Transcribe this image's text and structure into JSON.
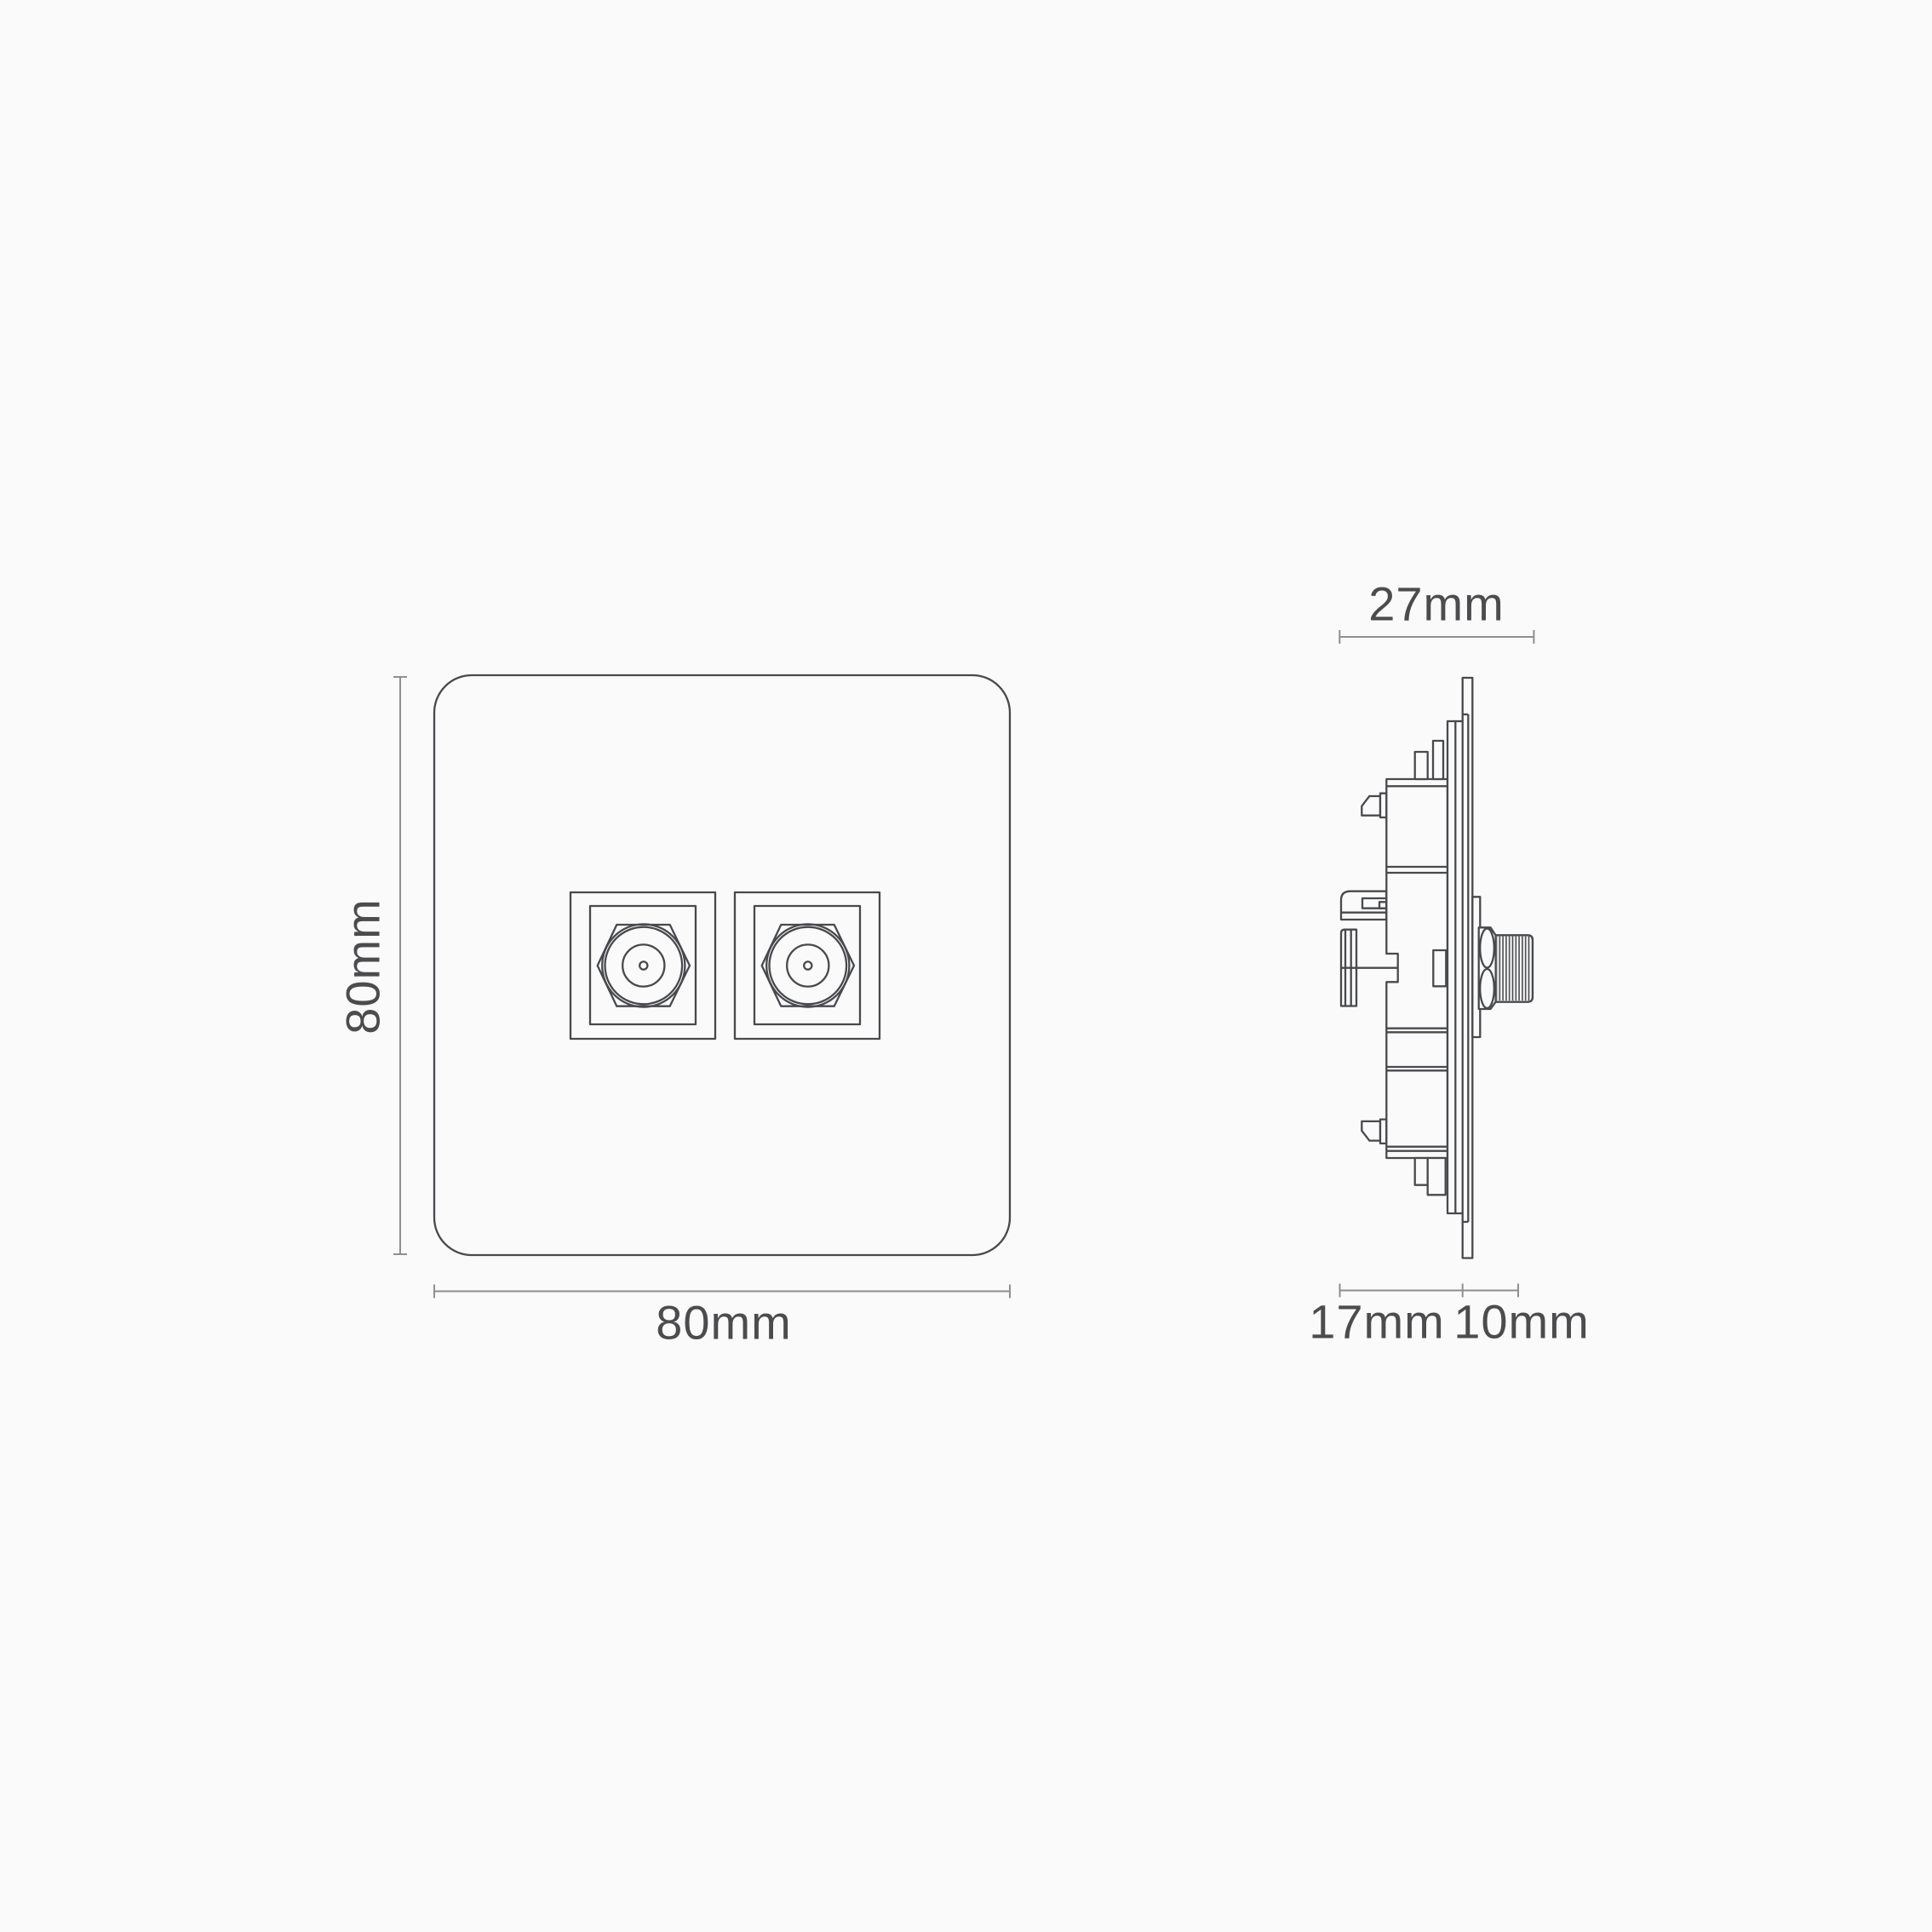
{
  "theme": {
    "bg": "#fafafa",
    "line": "#48494c",
    "dim": "#8e8f92",
    "text": "#4c4c4e"
  },
  "front_view": {
    "height_label": "80mm",
    "width_label": "80mm"
  },
  "side_view": {
    "depth_label": "27mm",
    "module_depth_label": "17mm",
    "connector_depth_label": "10mm"
  }
}
